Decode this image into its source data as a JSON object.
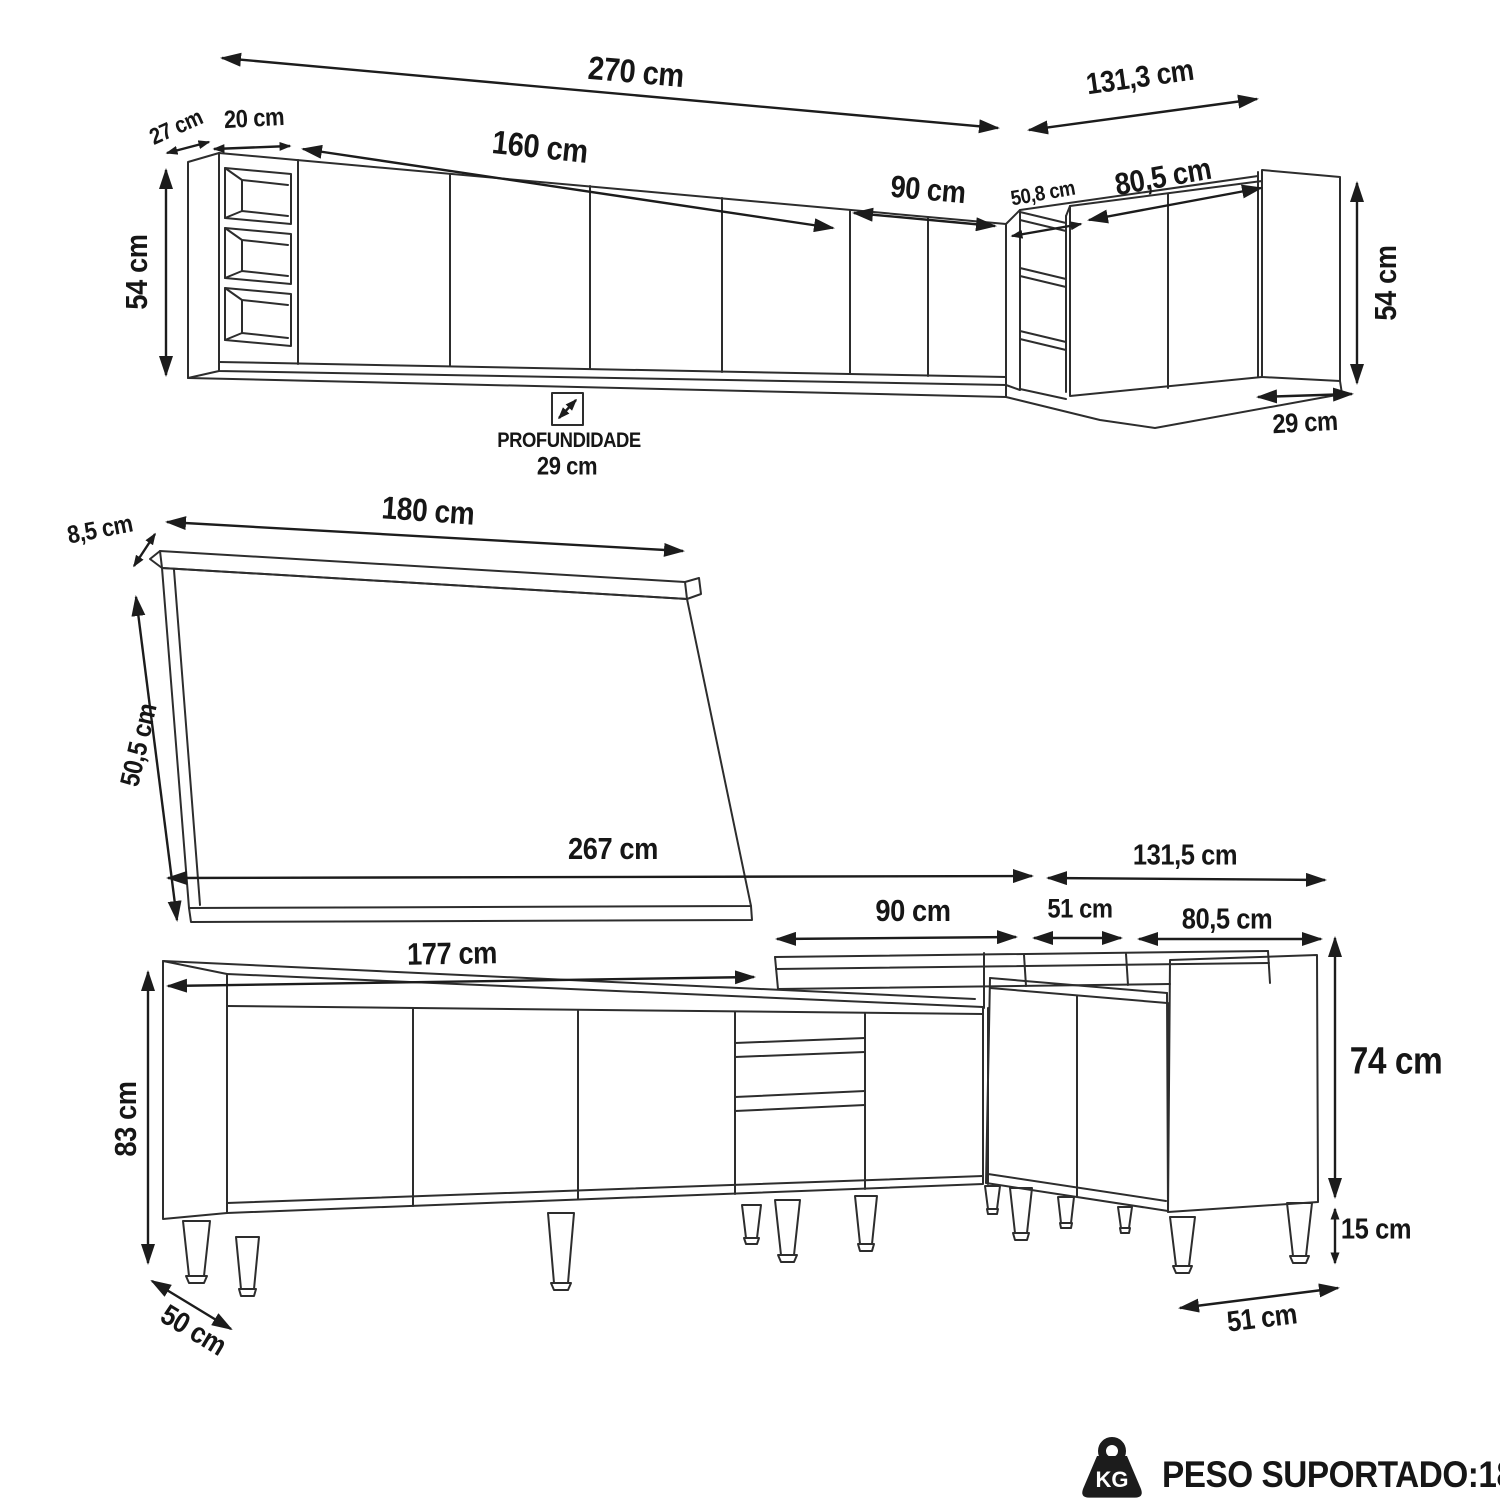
{
  "colors": {
    "background": "#ffffff",
    "line": "#2d2d2d",
    "text": "#161616"
  },
  "upper_section": {
    "dims": {
      "total_width": "270 cm",
      "right_run_width": "131,3 cm",
      "side_depth": "27 cm",
      "shelf_width": "20 cm",
      "doors_span": "160 cm",
      "corner_span": "90 cm",
      "corner_opening": "50,8 cm",
      "right_doors_span": "80,5 cm",
      "height_left": "54 cm",
      "height_right": "54 cm",
      "right_side_depth": "29 cm"
    },
    "depth_note": {
      "label": "PROFUNDIDADE",
      "value": "29 cm"
    }
  },
  "countertop_section": {
    "dims": {
      "length": "180 cm",
      "thickness": "8,5 cm",
      "depth": "50,5 cm"
    }
  },
  "base_section": {
    "dims": {
      "total_width": "267 cm",
      "right_run_width": "131,5 cm",
      "left_run_width": "177 cm",
      "corner_span": "90 cm",
      "corner_side": "51 cm",
      "right_doors_span": "80,5 cm",
      "body_height": "83 cm",
      "depth": "50 cm",
      "right_height": "74 cm",
      "leg_height": "15 cm",
      "right_side_depth": "51 cm"
    }
  },
  "footer": {
    "weight_icon_text": "KG",
    "supported_weight": "PESO SUPORTADO:180 KG"
  }
}
